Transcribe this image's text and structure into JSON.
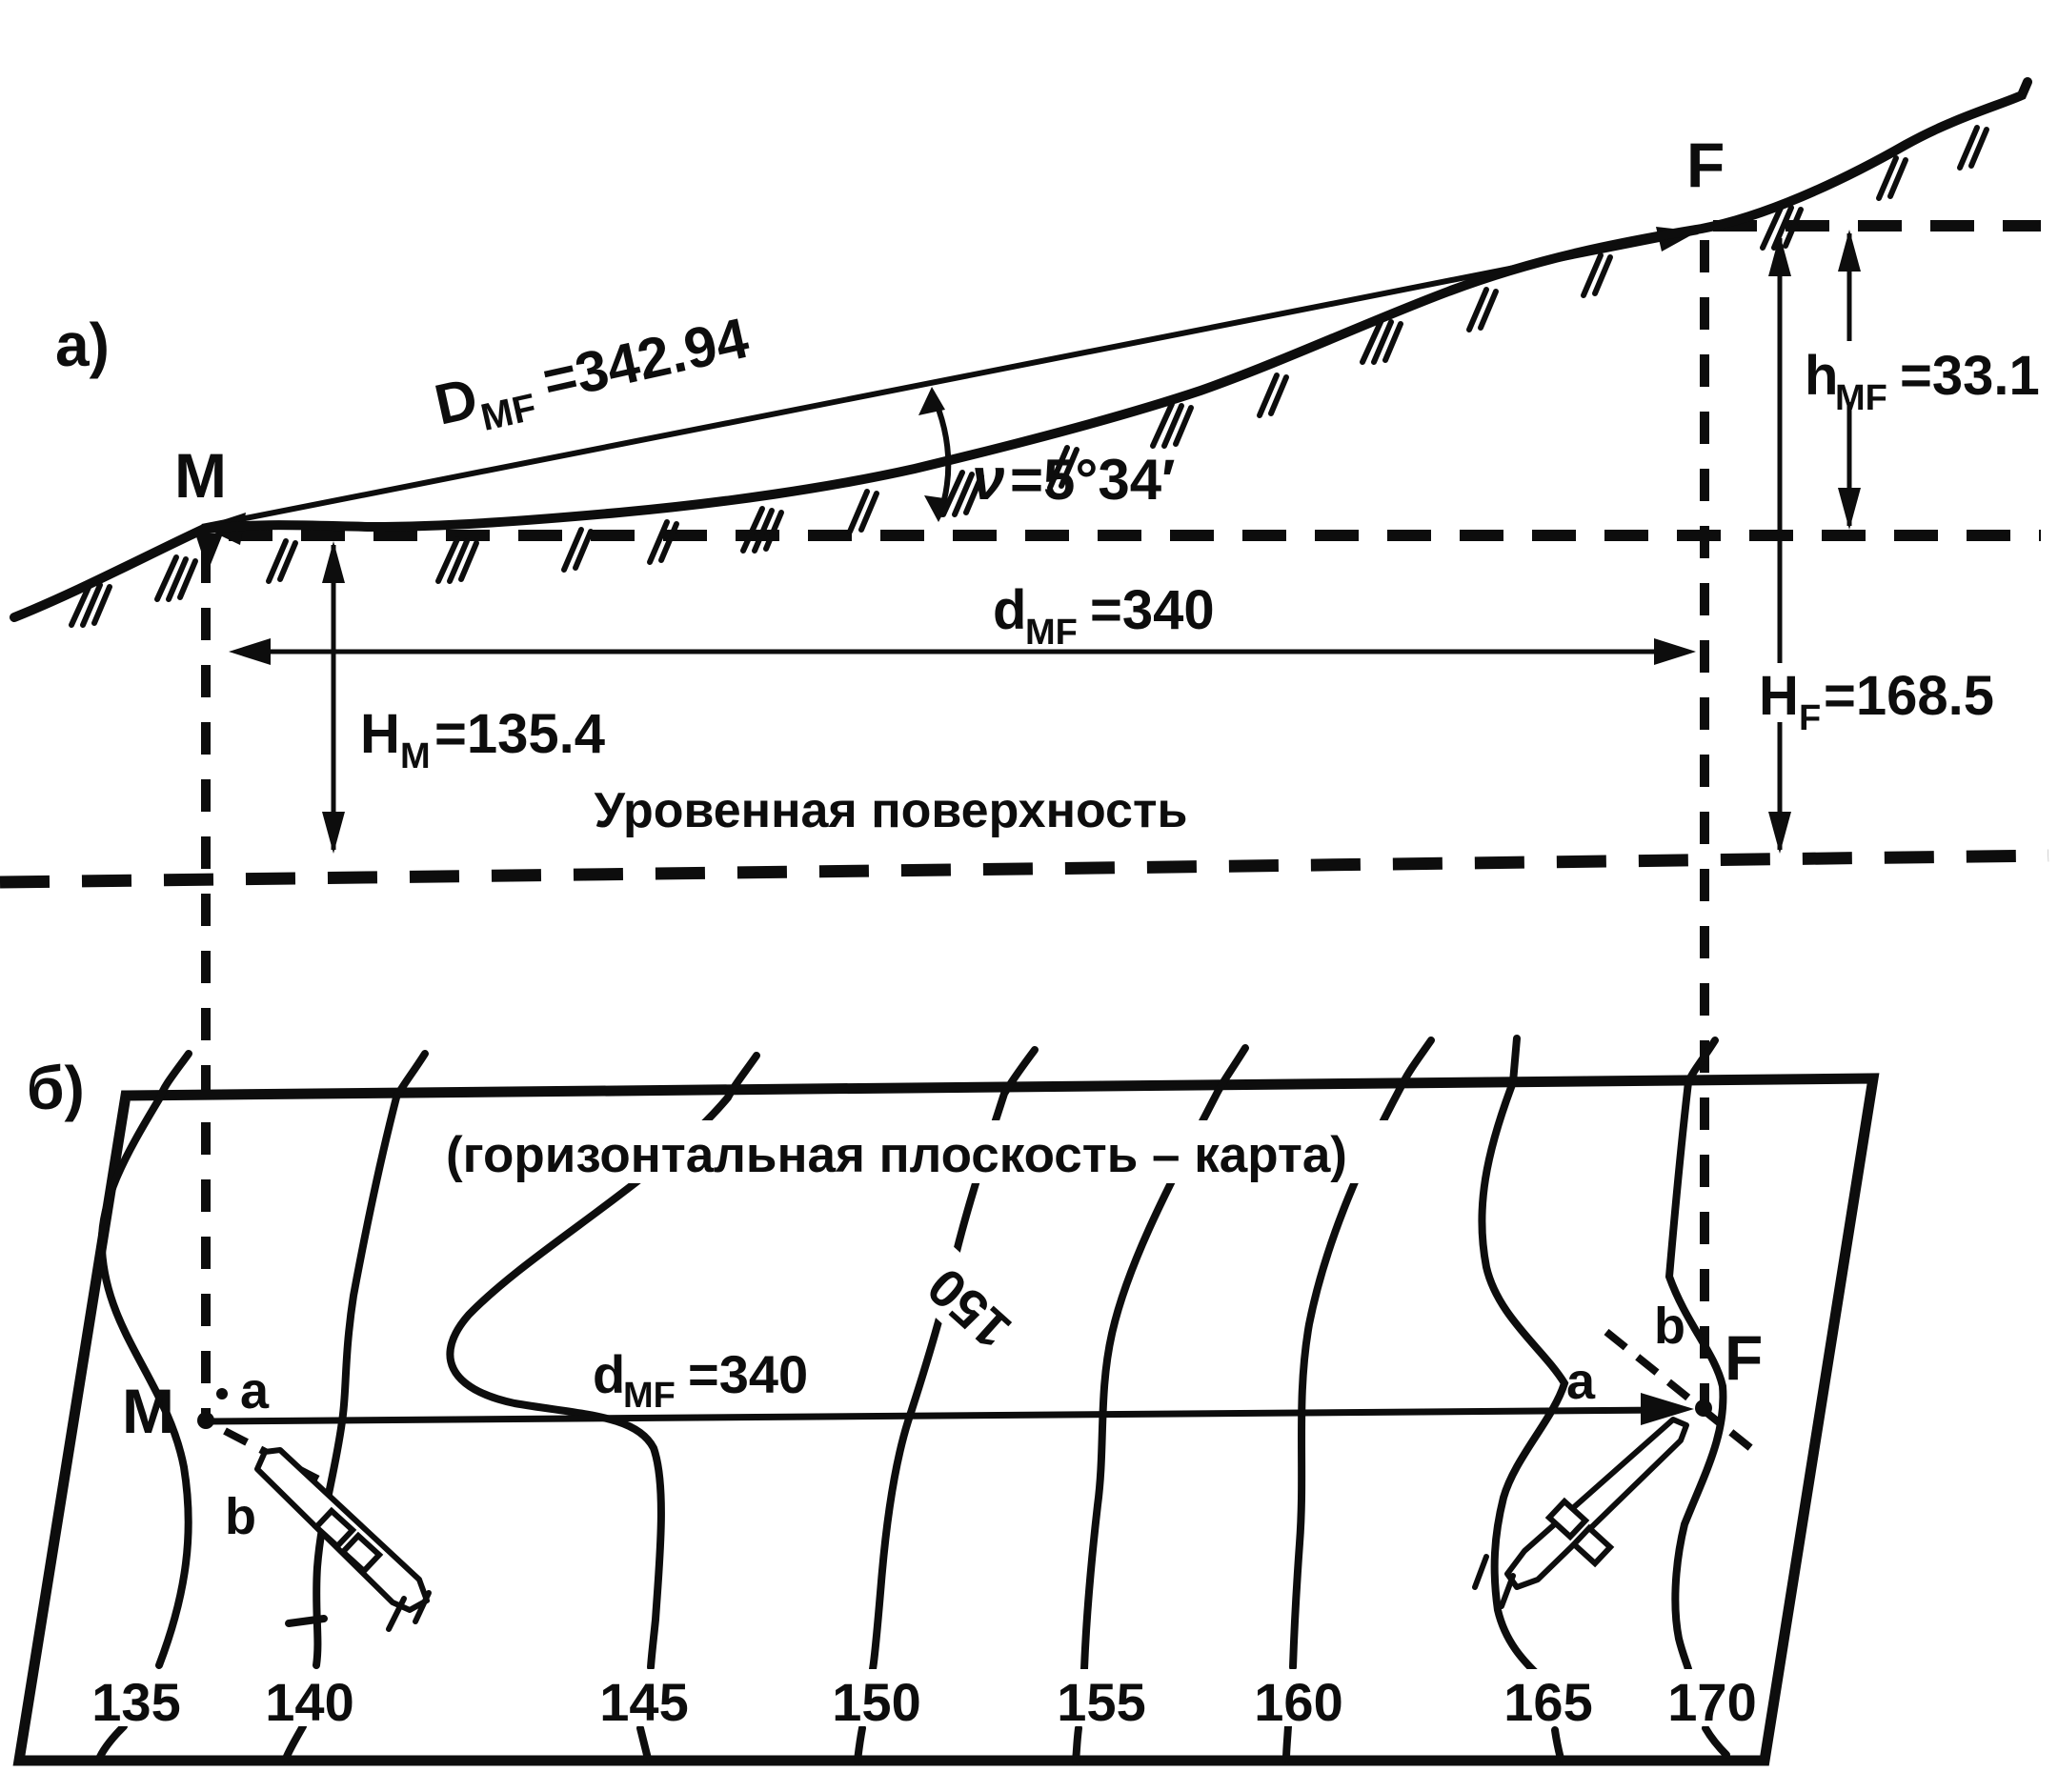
{
  "colors": {
    "ink": "#0d0d0d",
    "paper": "#ffffff"
  },
  "panel_a": {
    "label": "а)",
    "point_m": "M",
    "point_f": "F",
    "slope_distance": {
      "base": "D",
      "sub": "MF",
      "value": "=342.94"
    },
    "vertical_angle": {
      "symbol": "ν",
      "value": "=5°34′"
    },
    "horizontal_distance": {
      "base": "d",
      "sub": "MF",
      "value": "=340"
    },
    "height_m": {
      "base": "H",
      "sub": "M",
      "value": "=135.4"
    },
    "height_f": {
      "base": "H",
      "sub": "F",
      "value": "=168.5"
    },
    "elevation_difference": {
      "base": "h",
      "sub": "MF",
      "value": "=33.1"
    },
    "level_surface": "Уровенная поверхность"
  },
  "panel_b": {
    "label": "б)",
    "map_title": "(горизонтальная плоскость – карта)",
    "point_m": "M",
    "point_f": "F",
    "m_upper_point": "a",
    "m_lower_point": "b",
    "f_upper_point": "b",
    "f_lower_point": "a",
    "horizontal_distance": {
      "base": "d",
      "sub": "MF",
      "value": "=340"
    },
    "inline_contour_label": "150",
    "contour_labels": [
      "135",
      "140",
      "145",
      "150",
      "155",
      "160",
      "165",
      "170"
    ]
  }
}
